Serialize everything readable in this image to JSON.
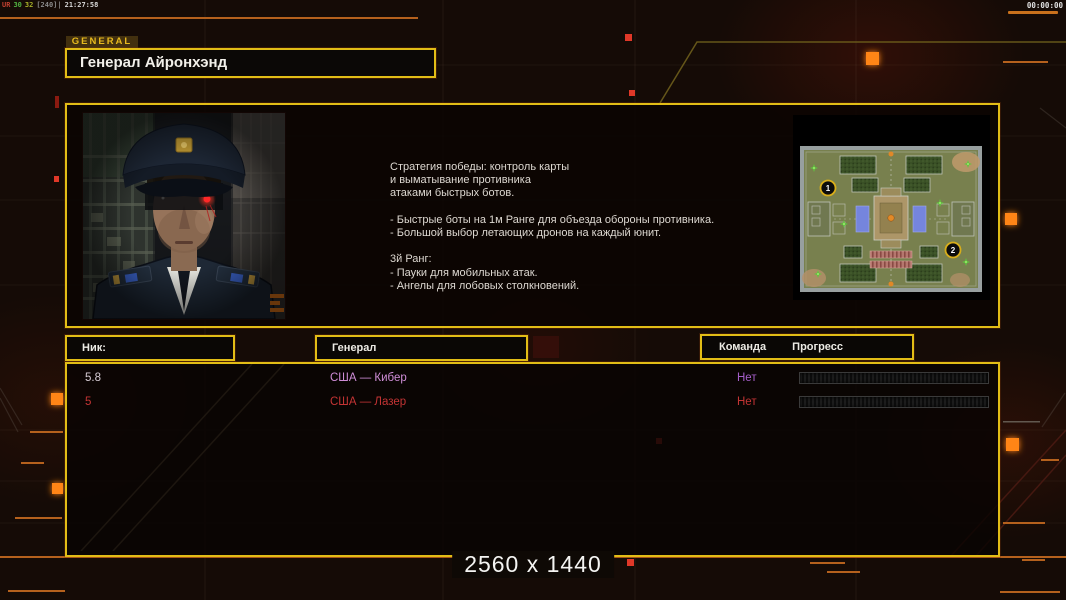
{
  "hud": {
    "perf_segments": [
      {
        "text": "UR",
        "color": "#c04030"
      },
      {
        "text": "30",
        "color": "#50b040"
      },
      {
        "text": "32",
        "color": "#a8b028"
      },
      {
        "text": "[240]|",
        "color": "#8a8a8a"
      },
      {
        "text": "21:27:58",
        "color": "#d8d8d8"
      }
    ],
    "match_timer": "00:00:00",
    "resolution_label": "2560 x 1440"
  },
  "header": {
    "tab_label": "GENERAL",
    "general_name": "Генерал Айронхэнд"
  },
  "profile": {
    "description": "Стратегия победы: контроль карты\nи выматывание противника\nатаками быстрых ботов.\n\n- Быстрые боты на 1м Ранге для объезда обороны противника.\n- Большой выбор летающих дронов на каждый юнит.\n\n3й Ранг:\n- Пауки для мобильных атак.\n- Ангелы для лобовых столкновений.",
    "minimap_markers": [
      "1",
      "2"
    ]
  },
  "players": {
    "headers": {
      "nick": "Ник:",
      "general": "Генерал",
      "team": "Команда",
      "progress": "Прогресс"
    },
    "rows": [
      {
        "nick": "5.8",
        "general": "США — Кибер",
        "team": "Нет",
        "progress_percent": 0,
        "colors": {
          "nick": "#d6ccd4",
          "general": "#d08ed8",
          "team": "#a55fc9"
        }
      },
      {
        "nick": "5",
        "general": "США — Лазер",
        "team": "Нет",
        "progress_percent": 0,
        "colors": {
          "nick": "#c43434",
          "general": "#c43434",
          "team": "#c43434"
        }
      }
    ]
  },
  "colors": {
    "panel_border": "#e2bd16",
    "accent_orange": "#b5611d",
    "glow_orange": "#ff8514",
    "alert_red": "#e03828"
  }
}
